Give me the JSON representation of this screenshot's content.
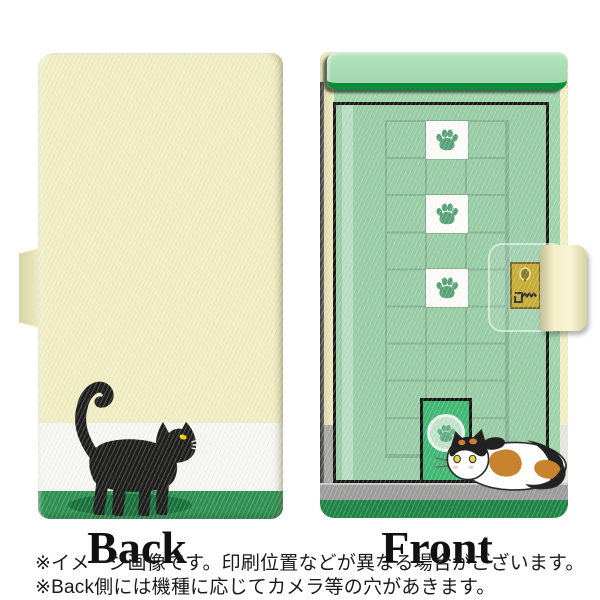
{
  "views": {
    "back": {
      "label": "Back",
      "illustration": "black-cat-walking"
    },
    "front": {
      "label": "Front",
      "illustration": "green-door-with-paw-tiles-lock-pet-door-and-calico-cat"
    }
  },
  "notes": {
    "line1": "※イメージ画像です。印刷位置などが異なる場合がございます。",
    "line2": "※Back側には機種に応じてカメラ等の穴があきます。"
  },
  "palette": {
    "case_cream": "#f1eec4",
    "stripe_white": "#f6f6f2",
    "ground_green": "#2c9150",
    "cat_shadow_green": "#17703a",
    "cat_black": "#1e1e1e",
    "eye_yellow": "#f0d000",
    "door_green": "#98cda6",
    "lintel_green": "#a8dcb4",
    "lintel_edge_green": "#0e8a3b",
    "grid_line_green": "#86b193",
    "paw_green": "#57a377",
    "pet_door_green": "#3fb873",
    "lock_gold": "#c2a31f",
    "floor_gray": "#9c9c9c",
    "base_green": "#1e8446",
    "calico_orange": "#c9822e"
  },
  "icons": {
    "paw": "paw-icon",
    "keyhole": "keyhole-icon",
    "key": "key-icon"
  }
}
